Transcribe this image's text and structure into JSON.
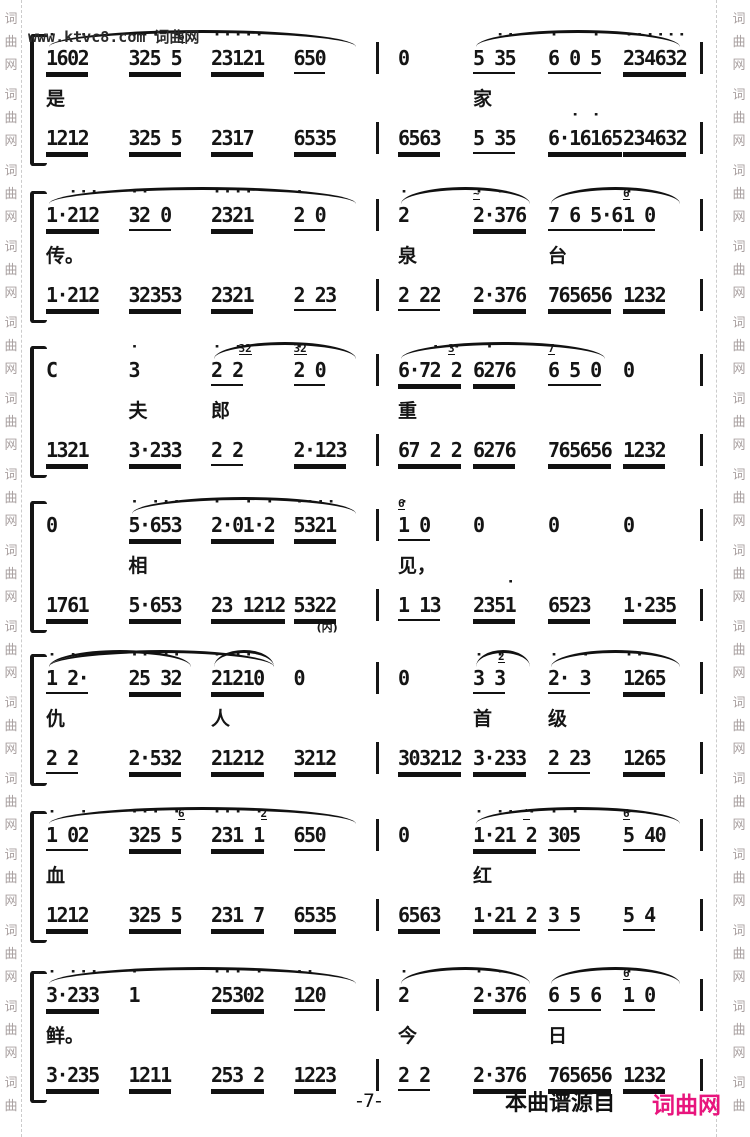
{
  "top_watermark": "www.ktvc8.com 词曲网",
  "side_watermark_chars": [
    "词",
    "曲",
    "网"
  ],
  "footer": {
    "page": "-7-",
    "source_text": "本曲谱源自",
    "brand": "词曲网",
    "brand_color": "#e8157d"
  },
  "systems": [
    {
      "left": {
        "slurs": [
          {
            "f": 0,
            "t": 3
          }
        ],
        "upper": [
          {
            "t": "1602",
            "u": 2,
            "d": [
              0,
              3
            ]
          },
          {
            "t": "325 5",
            "u": 2,
            "d": [
              0,
              1,
              2,
              4
            ],
            "g": {
              "t": "6",
              "i": 3
            }
          },
          {
            "t": "23121",
            "u": 2,
            "d": [
              0,
              1,
              2,
              3,
              4
            ]
          },
          {
            "t": "650",
            "u": 1
          }
        ],
        "lyrics": [
          {
            "c": 0,
            "t": "是"
          }
        ],
        "lower": [
          {
            "t": "1212",
            "u": 2
          },
          {
            "t": "325 5",
            "u": 2
          },
          {
            "t": "2317",
            "u": 2
          },
          {
            "t": "6535",
            "u": 2
          }
        ]
      },
      "right": {
        "slurs": [
          {
            "f": 1,
            "t": 3
          }
        ],
        "upper": [
          {
            "t": "0",
            "u": 0
          },
          {
            "t": "5 35",
            "u": 1,
            "d": [
              2,
              3
            ]
          },
          {
            "t": "6 0 5",
            "u": 1,
            "d": [
              0,
              4
            ]
          },
          {
            "t": "234632",
            "u": 2,
            "d": [
              0,
              1,
              2,
              3,
              4,
              5
            ]
          }
        ],
        "lyrics": [
          {
            "c": 1,
            "t": "家"
          }
        ],
        "lower": [
          {
            "t": "6563",
            "u": 2
          },
          {
            "t": "5 35",
            "u": 1
          },
          {
            "t": "6·16165",
            "u": 2,
            "d": [
              2,
              4
            ]
          },
          {
            "t": "234632",
            "u": 2
          }
        ]
      }
    },
    {
      "left": {
        "slurs": [
          {
            "f": 0,
            "t": 3
          }
        ],
        "upper": [
          {
            "t": "1·212",
            "u": 2,
            "d": [
              2,
              3,
              4
            ]
          },
          {
            "t": "32 0",
            "u": 1,
            "d": [
              0,
              1
            ]
          },
          {
            "t": "2321",
            "u": 2,
            "d": [
              0,
              1,
              2,
              3
            ]
          },
          {
            "t": "2 0",
            "u": 1,
            "d": [
              0
            ]
          }
        ],
        "lyrics": [
          {
            "c": 0,
            "t": "传。"
          }
        ],
        "lower": [
          {
            "t": "1·212",
            "u": 2
          },
          {
            "t": "32353",
            "u": 2
          },
          {
            "t": "2321",
            "u": 2
          },
          {
            "t": "2 23",
            "u": 1
          }
        ]
      },
      "right": {
        "slurs": [
          {
            "f": 0,
            "t": 1
          },
          {
            "f": 2,
            "t": 3
          }
        ],
        "upper": [
          {
            "t": "2",
            "u": 0,
            "d": [
              0
            ]
          },
          {
            "t": "2·376",
            "u": 2,
            "d": [
              0,
              2
            ],
            "g": {
              "t": "~",
              "i": 0
            }
          },
          {
            "t": "7 6 5·6",
            "u": 1
          },
          {
            "t": "1 0",
            "u": 1,
            "d": [
              0
            ],
            "g": {
              "t": "6",
              "i": 0
            }
          }
        ],
        "lyrics": [
          {
            "c": 0,
            "t": "泉"
          },
          {
            "c": 2,
            "t": "台"
          }
        ],
        "lower": [
          {
            "t": "2 22",
            "u": 1
          },
          {
            "t": "2·376",
            "u": 2
          },
          {
            "t": "765656",
            "u": 2
          },
          {
            "t": "1232",
            "u": 2
          }
        ]
      }
    },
    {
      "left": {
        "slurs": [
          {
            "f": 2,
            "t": 3
          }
        ],
        "upper": [
          {
            "t": "C",
            "u": 0
          },
          {
            "t": "3",
            "u": 0,
            "d": [
              0
            ]
          },
          {
            "t": "2 2",
            "u": 1,
            "d": [
              0,
              2
            ],
            "g": {
              "t": "32",
              "i": 1
            }
          },
          {
            "t": "2 0",
            "u": 1,
            "d": [
              0
            ],
            "g": {
              "t": "32",
              "i": 0
            }
          }
        ],
        "lyrics": [
          {
            "c": 1,
            "t": "夫"
          },
          {
            "c": 2,
            "t": "郎"
          }
        ],
        "lower": [
          {
            "t": "1321",
            "u": 2
          },
          {
            "t": "3·233",
            "u": 2
          },
          {
            "t": "2 2",
            "u": 1
          },
          {
            "t": "2·123",
            "u": 2
          }
        ]
      },
      "right": {
        "slurs": [
          {
            "f": 0,
            "t": 2
          }
        ],
        "upper": [
          {
            "t": "6·72 2",
            "u": 2,
            "d": [
              3,
              5
            ],
            "g": {
              "t": "3",
              "i": 4
            }
          },
          {
            "t": "6276",
            "u": 2,
            "d": [
              1
            ]
          },
          {
            "t": "6 5 0",
            "u": 1,
            "g": {
              "t": "7",
              "i": 0
            }
          },
          {
            "t": "0",
            "u": 0
          }
        ],
        "lyrics": [
          {
            "c": 0,
            "t": "重"
          }
        ],
        "lower": [
          {
            "t": "67 2 2",
            "u": 2
          },
          {
            "t": "6276",
            "u": 2
          },
          {
            "t": "765656",
            "u": 2
          },
          {
            "t": "1232",
            "u": 2
          }
        ]
      }
    },
    {
      "left": {
        "slurs": [
          {
            "f": 1,
            "t": 3
          }
        ],
        "upper": [
          {
            "t": "0",
            "u": 0
          },
          {
            "t": "5·653",
            "u": 2,
            "d": [
              0,
              2,
              3,
              4
            ]
          },
          {
            "t": "2·01·2",
            "u": 2,
            "d": [
              0,
              3,
              5
            ]
          },
          {
            "t": "5321",
            "u": 2,
            "d": [
              0,
              1,
              2,
              3
            ]
          }
        ],
        "lyrics": [
          {
            "c": 1,
            "t": "相"
          }
        ],
        "lower": [
          {
            "t": "1761",
            "u": 2
          },
          {
            "t": "5·653",
            "u": 2
          },
          {
            "t": "23 1212",
            "u": 2
          },
          {
            "t": "5322",
            "u": 2,
            "s": "(内)"
          }
        ]
      },
      "right": {
        "slurs": [],
        "upper": [
          {
            "t": "1 0",
            "u": 1,
            "d": [
              0
            ],
            "g": {
              "t": "6",
              "i": 0
            }
          },
          {
            "t": "0",
            "u": 0
          },
          {
            "t": "0",
            "u": 0
          },
          {
            "t": "0",
            "u": 0
          }
        ],
        "lyrics": [
          {
            "c": 0,
            "t": "见，"
          }
        ],
        "lower": [
          {
            "t": "1 13",
            "u": 1
          },
          {
            "t": "2351",
            "u": 2,
            "d": [
              3
            ]
          },
          {
            "t": "6523",
            "u": 2
          },
          {
            "t": "1·235",
            "u": 2
          }
        ]
      }
    },
    {
      "left": {
        "slurs": [
          {
            "f": 0,
            "t": 2
          },
          {
            "f": 0,
            "t": 1
          },
          {
            "f": 2,
            "t": 2
          }
        ],
        "upper": [
          {
            "t": "1 2·",
            "u": 1,
            "d": [
              0,
              2
            ]
          },
          {
            "t": "25 32",
            "u": 2,
            "d": [
              0,
              1,
              3,
              4
            ]
          },
          {
            "t": "21210",
            "u": 2,
            "d": [
              0,
              1,
              2,
              3
            ]
          },
          {
            "t": "0",
            "u": 0
          }
        ],
        "lyrics": [
          {
            "c": 0,
            "t": "仇"
          },
          {
            "c": 2,
            "t": "人"
          }
        ],
        "lower": [
          {
            "t": "2 2",
            "u": 1
          },
          {
            "t": "2·532",
            "u": 2
          },
          {
            "t": "21212",
            "u": 2
          },
          {
            "t": "3212",
            "u": 2
          }
        ]
      },
      "right": {
        "slurs": [
          {
            "f": 1,
            "t": 1
          },
          {
            "f": 2,
            "t": 3
          }
        ],
        "upper": [
          {
            "t": "0",
            "u": 0
          },
          {
            "t": "3 3",
            "u": 1,
            "d": [
              0,
              2
            ],
            "g": {
              "t": "2",
              "i": 1
            }
          },
          {
            "t": "2· 3",
            "u": 1,
            "d": [
              0,
              3
            ]
          },
          {
            "t": "1265",
            "u": 2,
            "d": [
              0,
              1
            ]
          }
        ],
        "lyrics": [
          {
            "c": 1,
            "t": "首"
          },
          {
            "c": 2,
            "t": "级"
          }
        ],
        "lower": [
          {
            "t": "303212",
            "u": 2
          },
          {
            "t": "3·233",
            "u": 2
          },
          {
            "t": "2 23",
            "u": 1
          },
          {
            "t": "1265",
            "u": 2
          }
        ]
      }
    },
    {
      "left": {
        "slurs": [
          {
            "f": 0,
            "t": 3
          }
        ],
        "upper": [
          {
            "t": "1 02",
            "u": 1,
            "d": [
              0,
              3
            ]
          },
          {
            "t": "325 5",
            "u": 2,
            "d": [
              0,
              1,
              2,
              4
            ],
            "g": {
              "t": "6",
              "i": 3
            }
          },
          {
            "t": "231 1",
            "u": 2,
            "d": [
              0,
              1,
              2,
              4
            ],
            "g": {
              "t": "2",
              "i": 3
            }
          },
          {
            "t": "650",
            "u": 1
          }
        ],
        "lyrics": [
          {
            "c": 0,
            "t": "血"
          }
        ],
        "lower": [
          {
            "t": "1212",
            "u": 2
          },
          {
            "t": "325 5",
            "u": 2
          },
          {
            "t": "231 7",
            "u": 2
          },
          {
            "t": "6535",
            "u": 2
          }
        ]
      },
      "right": {
        "slurs": [
          {
            "f": 1,
            "t": 3
          }
        ],
        "upper": [
          {
            "t": "0",
            "u": 0
          },
          {
            "t": "1·21 2",
            "u": 2,
            "d": [
              0,
              2,
              3,
              5
            ],
            "g": {
              "t": "'",
              "i": 4
            }
          },
          {
            "t": "305",
            "u": 1,
            "d": [
              0,
              2
            ]
          },
          {
            "t": "5 40",
            "u": 1,
            "d": [
              0
            ],
            "g": {
              "t": "6",
              "i": 0
            }
          }
        ],
        "lyrics": [
          {
            "c": 1,
            "t": "红"
          }
        ],
        "lower": [
          {
            "t": "6563",
            "u": 2
          },
          {
            "t": "1·21 2",
            "u": 2
          },
          {
            "t": "3 5",
            "u": 1
          },
          {
            "t": "5 4",
            "u": 1
          }
        ]
      }
    },
    {
      "left": {
        "slurs": [
          {
            "f": 0,
            "t": 3
          }
        ],
        "upper": [
          {
            "t": "3·233",
            "u": 2,
            "d": [
              0,
              2,
              3,
              4
            ]
          },
          {
            "t": "1",
            "u": 0,
            "d": [
              0
            ]
          },
          {
            "t": "25302",
            "u": 2,
            "d": [
              0,
              1,
              2,
              4
            ]
          },
          {
            "t": "120",
            "u": 1,
            "d": [
              0,
              1
            ]
          }
        ],
        "lyrics": [
          {
            "c": 0,
            "t": "鲜。"
          }
        ],
        "lower": [
          {
            "t": "3·235",
            "u": 2
          },
          {
            "t": "1211",
            "u": 2
          },
          {
            "t": "253 2",
            "u": 2
          },
          {
            "t": "1223",
            "u": 2
          }
        ]
      },
      "right": {
        "slurs": [
          {
            "f": 0,
            "t": 1
          },
          {
            "f": 2,
            "t": 3
          }
        ],
        "upper": [
          {
            "t": "2",
            "u": 0,
            "d": [
              0
            ]
          },
          {
            "t": "2·376",
            "u": 2,
            "d": [
              0,
              2
            ]
          },
          {
            "t": "6 5 6",
            "u": 1
          },
          {
            "t": "1 0",
            "u": 1,
            "d": [
              0
            ],
            "g": {
              "t": "6",
              "i": 0
            }
          }
        ],
        "lyrics": [
          {
            "c": 0,
            "t": "今"
          },
          {
            "c": 2,
            "t": "日"
          }
        ],
        "lower": [
          {
            "t": "2 2",
            "u": 1
          },
          {
            "t": "2·376",
            "u": 2
          },
          {
            "t": "765656",
            "u": 2
          },
          {
            "t": "1232",
            "u": 2
          }
        ]
      }
    }
  ]
}
